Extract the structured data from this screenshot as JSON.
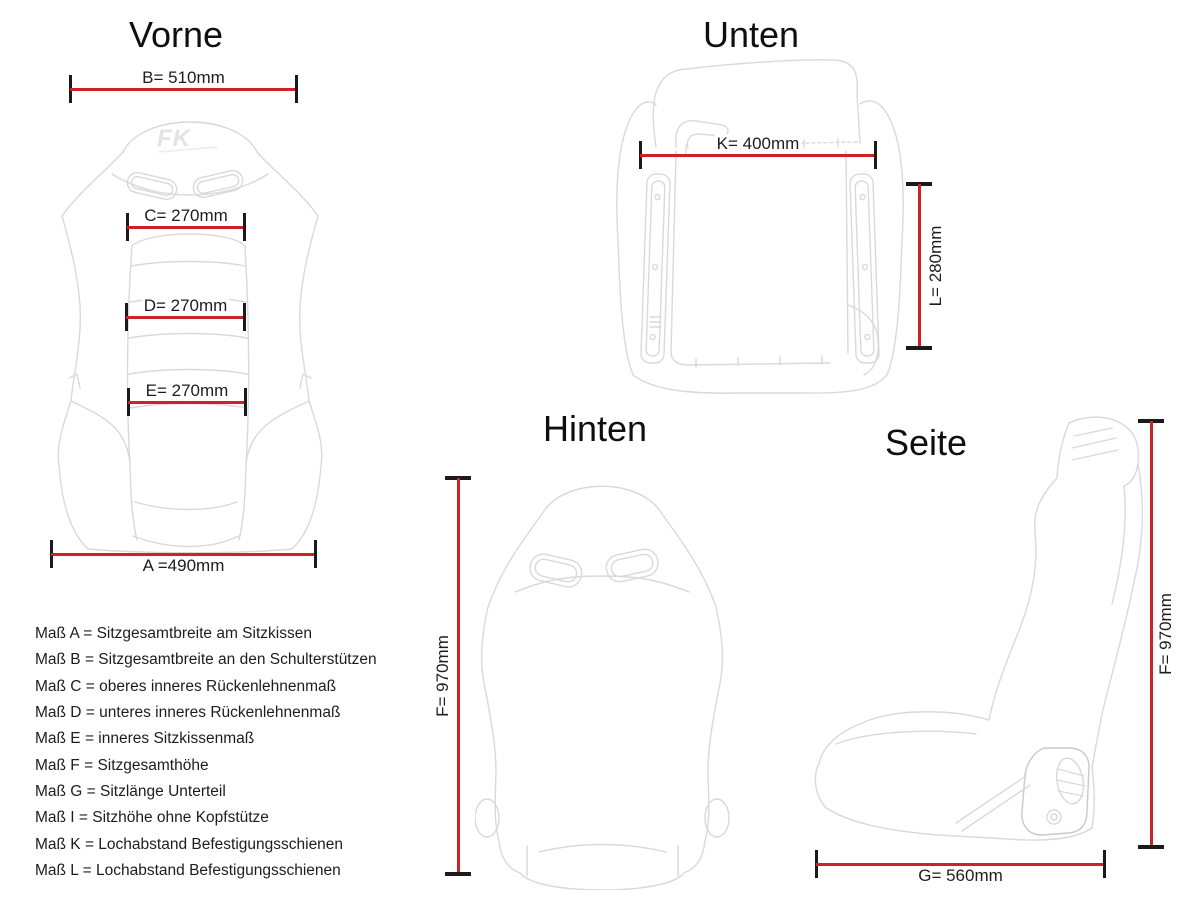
{
  "page": {
    "background": "#ffffff"
  },
  "colors": {
    "dimension_line": "#cc2228",
    "tick": "#1a1a1a",
    "label_text": "#1d1d1d",
    "sketch_line": "#d9d9d9"
  },
  "views": {
    "vorne": {
      "title": "Vorne",
      "logo": "FK",
      "dimensions": {
        "B": {
          "label": "B= 510mm",
          "value_mm": 510
        },
        "C": {
          "label": "C= 270mm",
          "value_mm": 270
        },
        "D": {
          "label": "D= 270mm",
          "value_mm": 270
        },
        "E": {
          "label": "E= 270mm",
          "value_mm": 270
        },
        "A": {
          "label": "A =490mm",
          "value_mm": 490
        }
      }
    },
    "unten": {
      "title": "Unten",
      "dimensions": {
        "K": {
          "label": "K= 400mm",
          "value_mm": 400
        },
        "L": {
          "label": "L= 280mm",
          "value_mm": 280
        }
      }
    },
    "hinten": {
      "title": "Hinten",
      "dimensions": {
        "F": {
          "label": "F= 970mm",
          "value_mm": 970
        }
      }
    },
    "seite": {
      "title": "Seite",
      "dimensions": {
        "F": {
          "label": "F= 970mm",
          "value_mm": 970
        },
        "G": {
          "label": "G= 560mm",
          "value_mm": 560
        }
      }
    }
  },
  "legend": {
    "items": [
      "Maß A = Sitzgesamtbreite am Sitzkissen",
      "Maß B = Sitzgesamtbreite an den Schulterstützen",
      "Maß C = oberes inneres Rückenlehnenmaß",
      "Maß D = unteres inneres Rückenlehnenmaß",
      "Maß E = inneres Sitzkissenmaß",
      "Maß F = Sitzgesamthöhe",
      "Maß G = Sitzlänge Unterteil",
      "Maß I = Sitzhöhe ohne Kopfstütze",
      "Maß K = Lochabstand Befestigungsschienen",
      "Maß L = Lochabstand Befestigungsschienen"
    ]
  }
}
